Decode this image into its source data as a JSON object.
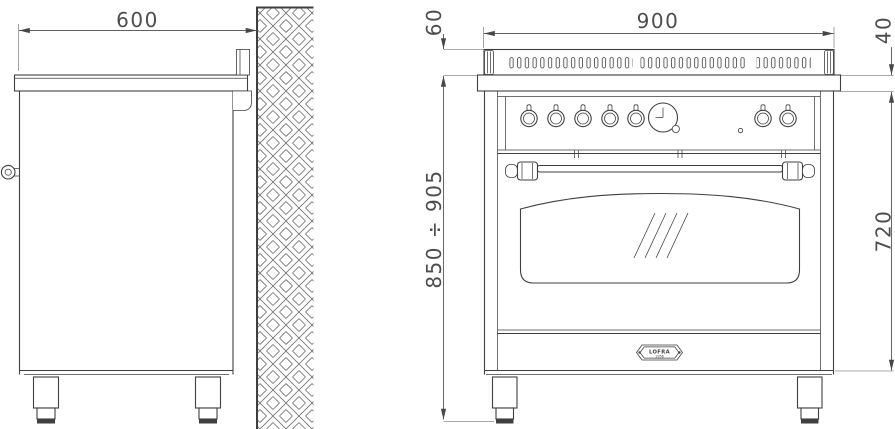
{
  "drawing": {
    "dimensions": {
      "side_depth": "600",
      "front_width": "900",
      "backguard_height": "60",
      "worktop_thickness": "40",
      "overall_height": "850 ÷ 905",
      "body_height": "720"
    },
    "badge": {
      "brand": "LOFRA",
      "year": "1956"
    },
    "colors": {
      "outline": "#3f3f3f",
      "dimension_line": "#5f5f5f",
      "dimension_text": "#4d4d4d",
      "background": "#ffffff"
    }
  }
}
